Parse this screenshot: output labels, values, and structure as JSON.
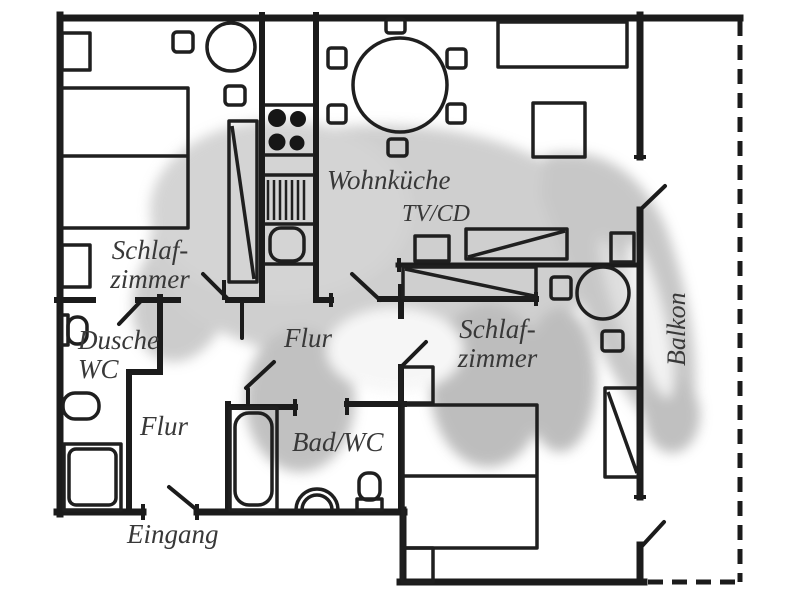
{
  "plan": {
    "watermark_subject": "badger",
    "colors": {
      "wall": "#1b1b1b",
      "furniture": "#1f1f1f",
      "label": "#383838",
      "watermark_gray": "#b5b5b5",
      "background": "#ffffff"
    },
    "rooms": {
      "bedroom_left": {
        "line1": "Schlaf-",
        "line2": "zimmer"
      },
      "shower_wc": {
        "line1": "Dusche",
        "line2": "WC"
      },
      "hall_center": {
        "label": "Flur"
      },
      "hall_entry": {
        "label": "Flur"
      },
      "living_kitchen": {
        "label": "Wohnküche"
      },
      "tv_cd": {
        "label": "TV/CD"
      },
      "bath_wc": {
        "label": "Bad/WC"
      },
      "entrance": {
        "label": "Eingang"
      },
      "bedroom_right": {
        "line1": "Schlaf-",
        "line2": "zimmer"
      },
      "balcony": {
        "label": "Balkon"
      }
    }
  }
}
